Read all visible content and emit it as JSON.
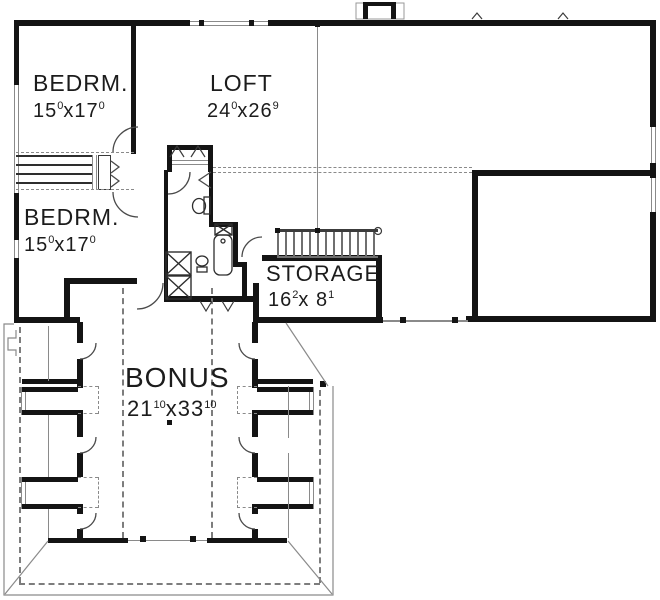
{
  "plan": {
    "colors": {
      "wall": "#141414",
      "thin_line": "#8a8a8a",
      "dash": "#7d7d7d",
      "background": "#ffffff",
      "text": "#1c1c1c"
    },
    "rooms": [
      {
        "name": "BEDRM.",
        "dim_a": "15",
        "dim_a_sup": "0",
        "mult": "x",
        "dim_b": "17",
        "dim_b_sup": "0"
      },
      {
        "name": "LOFT",
        "dim_a": "24",
        "dim_a_sup": "0",
        "mult": "x",
        "dim_b": "26",
        "dim_b_sup": "9"
      },
      {
        "name": "BEDRM.",
        "dim_a": "15",
        "dim_a_sup": "0",
        "mult": "x",
        "dim_b": "17",
        "dim_b_sup": "0"
      },
      {
        "name": "STORAGE",
        "dim_a": "16",
        "dim_a_sup": "2",
        "mult": "x ",
        "dim_b": " 8",
        "dim_b_sup": "1"
      },
      {
        "name": "BONUS",
        "dim_a": "21",
        "dim_a_sup": "10",
        "mult": "x",
        "dim_b": "33",
        "dim_b_sup": "10"
      }
    ]
  }
}
